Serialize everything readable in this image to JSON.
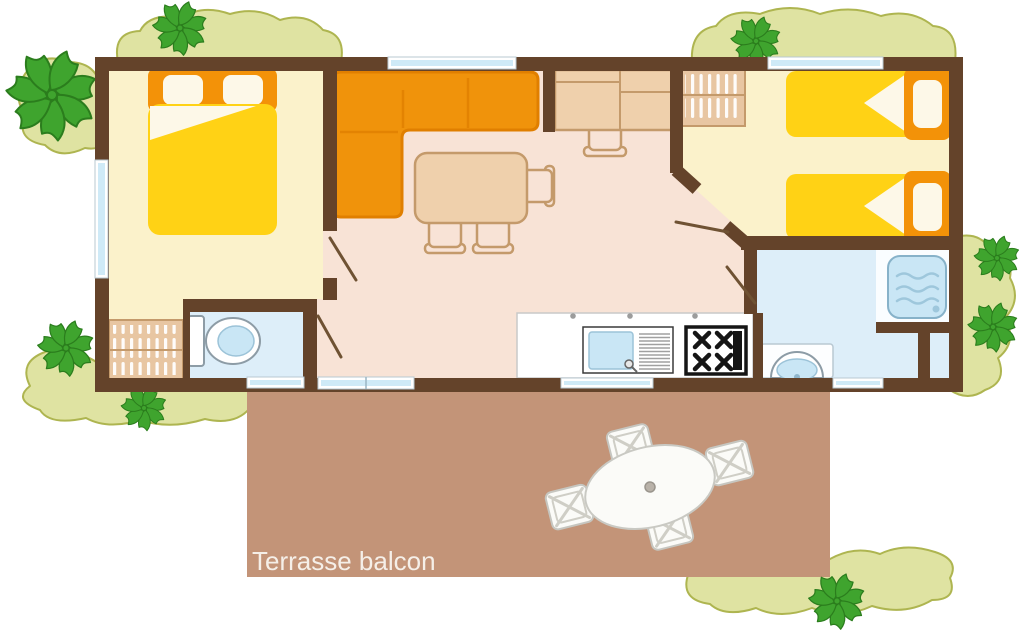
{
  "terrace": {
    "label": "Terrasse balcon"
  },
  "colors": {
    "wall": "#64432a",
    "door": "#6f5233",
    "floor_bedroom": "#fbf2cb",
    "floor_living": "#f8e3d6",
    "floor_wet": "#ddeef9",
    "glass": "#cfeaf7",
    "bush": "#dfe3a2",
    "bush_line": "#aeb550",
    "tree": "#3fa42e",
    "tree_line": "#2b7d1d",
    "furn_tan": "#efd0ac",
    "furn_line": "#c49a6b",
    "wardrobe": "#e8c6a2",
    "bed_yellow": "#ffd215",
    "bed_orange": "#f39208",
    "pillow": "#fdf8e8",
    "sofa_dark": "#e07f00",
    "sofa_light": "#f0930b",
    "shower_tray": "#c9e6f5",
    "terrace": "#c39478",
    "terrace_text": "#f5efe8"
  },
  "icons": {
    "tree": "pinwheel-tree",
    "bush": "cloud-bush"
  }
}
